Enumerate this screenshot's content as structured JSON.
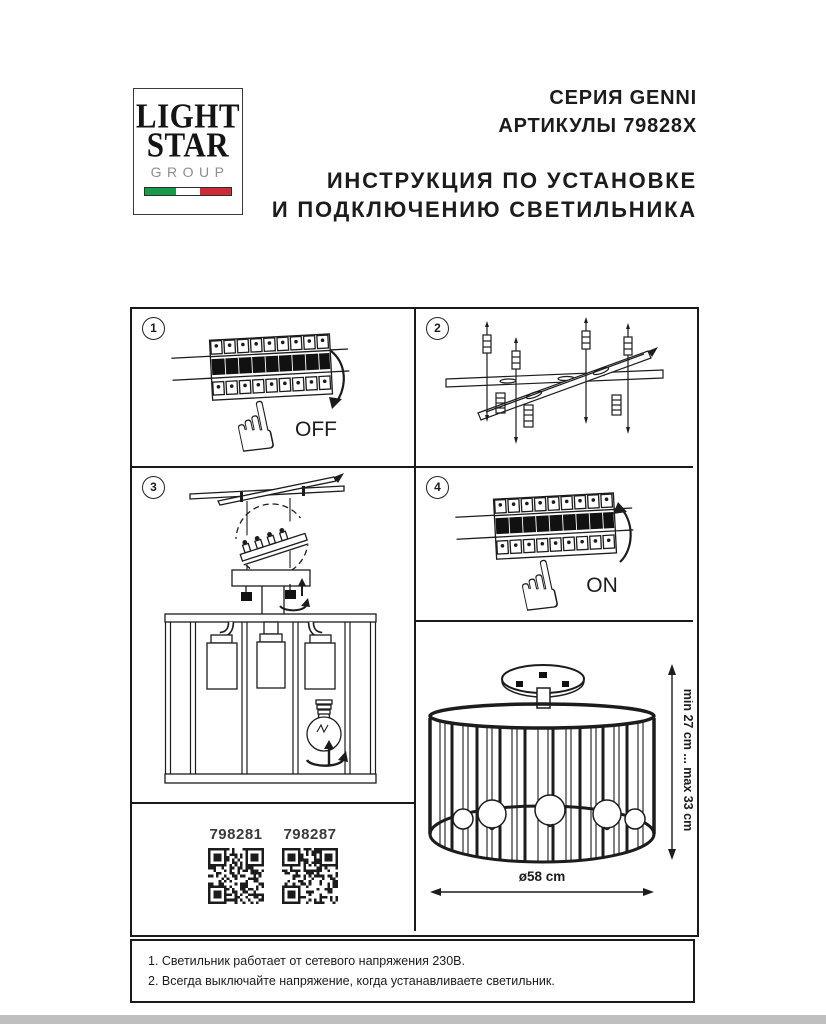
{
  "logo": {
    "word1": "LIGHT",
    "word2": "STAR",
    "word3": "GROUP",
    "flag_green": "#169b4a",
    "flag_white": "#ffffff",
    "flag_red": "#ce2b37"
  },
  "header": {
    "series": "СЕРИЯ GENNI",
    "articles": "АРТИКУЛЫ 79828X",
    "title_line1": "ИНСТРУКЦИЯ ПО УСТАНОВКЕ",
    "title_line2": "И ПОДКЛЮЧЕНИЮ СВЕТИЛЬНИКА"
  },
  "steps": {
    "s1": {
      "num": "1",
      "label": "OFF"
    },
    "s2": {
      "num": "2"
    },
    "s3": {
      "num": "3"
    },
    "s4": {
      "num": "4",
      "label": "ON"
    }
  },
  "icons": {
    "hand": "☝"
  },
  "qr": {
    "left_code": "798281",
    "right_code": "798287"
  },
  "dimensions": {
    "height": "min 27 cm ... max 33 cm",
    "diameter": "ø58 cm"
  },
  "notes": {
    "line1": "1. Светильник работает от сетевого напряжения 230В.",
    "line2": "2. Всегда выключайте напряжение, когда устанавливаете светильник."
  },
  "colors": {
    "ink": "#1c1c1c"
  }
}
